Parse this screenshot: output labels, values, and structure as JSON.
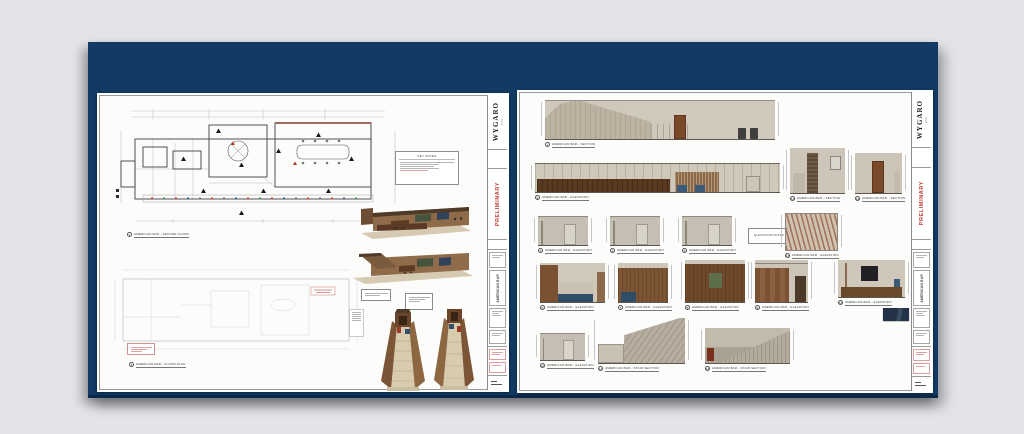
{
  "board": {
    "color": "#123a63"
  },
  "left_sheet": {
    "titleblock": {
      "logo": "WYGARO",
      "logo_sub": "350",
      "preliminary": "PRELIMINARY",
      "project": "AMERICAN BAR"
    },
    "legend": {
      "title": "KEY NOTES"
    },
    "captions": [
      {
        "num": "1",
        "title": "AMERICAN BAR - SECOND FLOOR"
      },
      {
        "num": "2",
        "title": "AMERICAN BAR - FLOOR PLAN"
      }
    ]
  },
  "right_sheet": {
    "titleblock": {
      "logo": "WYGARO",
      "logo_sub": "350",
      "preliminary": "PRELIMINARY",
      "project": "AMERICAN BAR"
    },
    "note_box": "ELEVATIONS NOTED",
    "captions": [
      {
        "num": "1",
        "title": "AMERICAN BAR - SECTION"
      },
      {
        "num": "2",
        "title": "AMERICAN BAR - ELEVATION"
      },
      {
        "num": "3",
        "title": "AMERICAN BAR - ELEVATION"
      },
      {
        "num": "4",
        "title": "AMERICAN BAR - ELEVATION"
      },
      {
        "num": "5",
        "title": "AMERICAN BAR - ELEVATION"
      },
      {
        "num": "6",
        "title": "AMERICAN BAR - ELEVATION"
      },
      {
        "num": "7",
        "title": "AMERICAN BAR - ELEVATION"
      },
      {
        "num": "8",
        "title": "AMERICAN BAR - ELEVATION"
      },
      {
        "num": "9",
        "title": "AMERICAN BAR - ELEVATION"
      },
      {
        "num": "10",
        "title": "AMERICAN BAR - ELEVATION"
      },
      {
        "num": "11",
        "title": "AMERICAN BAR - STAIR SECTION"
      },
      {
        "num": "12",
        "title": "AMERICAN BAR - STAIR SECTION"
      },
      {
        "num": "13",
        "title": "AMERICAN BAR - SECTION"
      },
      {
        "num": "14",
        "title": "AMERICAN BAR - SECTION"
      },
      {
        "num": "15",
        "title": "AMERICAN BAR - ELEVATION"
      },
      {
        "num": "16",
        "title": "AMERICAN BAR - ELEVATION"
      }
    ]
  }
}
